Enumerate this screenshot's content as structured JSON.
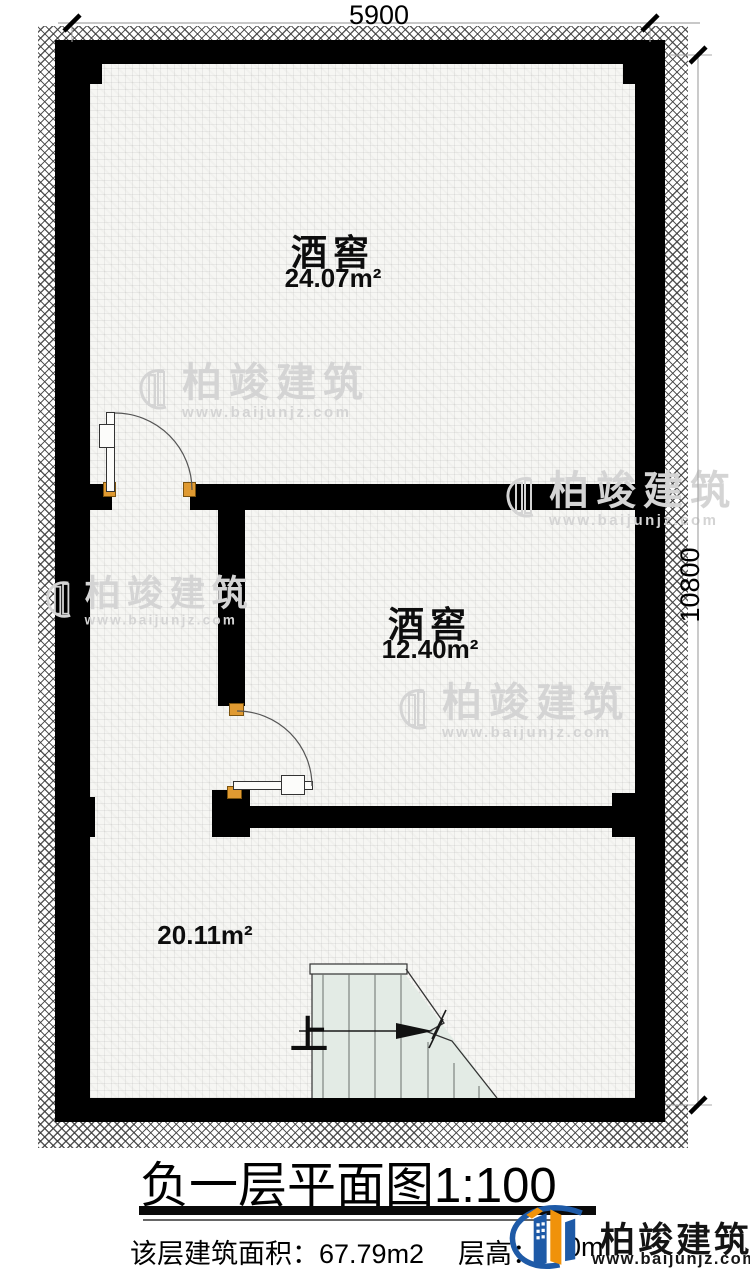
{
  "plan": {
    "dim_top": "5900",
    "dim_right": "10800",
    "rooms": [
      {
        "name": "酒窖",
        "area": "24.07m²"
      },
      {
        "name": "酒窖",
        "area": "12.40m²"
      },
      {
        "name": "",
        "area": "20.11m²"
      }
    ],
    "stair_up_label": "上"
  },
  "title": {
    "text": "负一层平面图",
    "scale": "1:100"
  },
  "footer": {
    "area_label": "该层建筑面积：",
    "area_value": "67.79m2",
    "height_label": "层高：",
    "height_value_partial": "0m"
  },
  "brand": {
    "name": "柏竣建筑",
    "url": "www.baijunjz.com"
  },
  "watermark": {
    "name": "柏竣建筑",
    "url": "www.baijunjz.com"
  },
  "colors": {
    "wall": "#000000",
    "floor": "#f6f6f3",
    "stair_fill": "#e3ebe5",
    "door_stop": "#e09a31",
    "brand_blue": "#1e5aa7",
    "brand_orange": "#f0920a",
    "watermark_gray": "#d4d4d4"
  }
}
